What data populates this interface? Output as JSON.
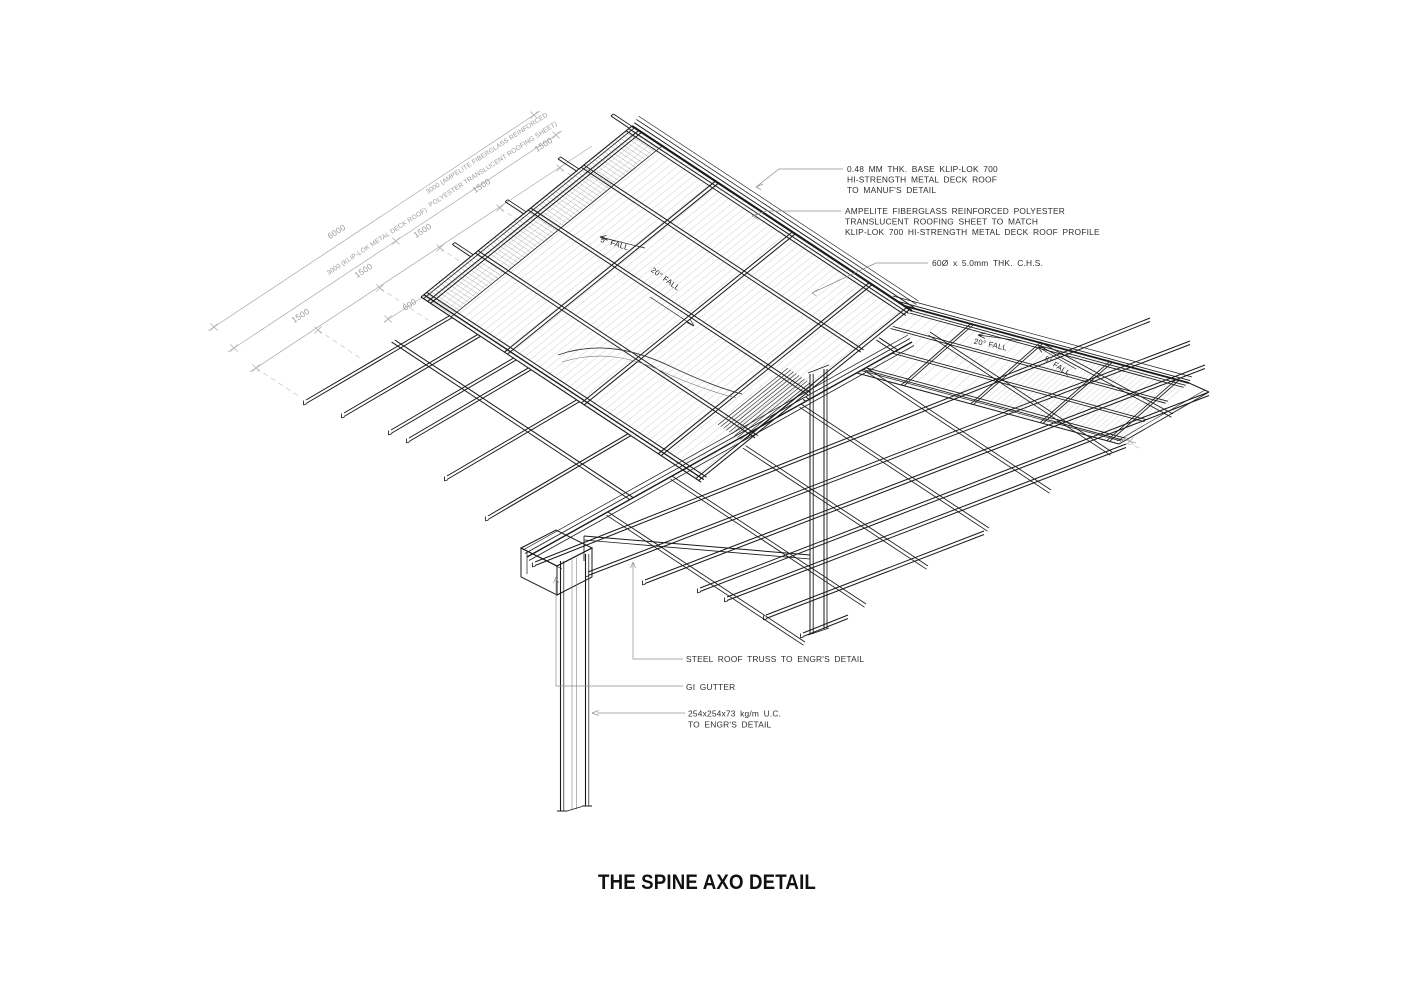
{
  "title": "THE SPINE AXO DETAIL",
  "colors": {
    "line": "#1a1a1a",
    "dim_gray": "#9a9a9a",
    "corrugation": "#c4c4c4",
    "note_text": "#2e2e2e",
    "background": "#ffffff"
  },
  "dimensions": {
    "bays": [
      "1500",
      "1500",
      "1500",
      "1500",
      "1500"
    ],
    "offset_600": "600",
    "total_span": "6000",
    "span_kliplok": "3000 (KLIP-LOK METAL DECK ROOF)",
    "span_ampelite_1": "3000 (AMPELITE FIBERGLASS REINFORCED",
    "span_ampelite_2": "POLYESTER TRANSLUCENT ROOFING SHEET)",
    "edge_650": "650"
  },
  "falls": {
    "left_low": "5° FALL",
    "left_steep": "20° FALL",
    "right_steep": "20° FALL",
    "right_low": "5° FALL"
  },
  "notes": {
    "metal_deck": [
      "0.48 MM THK. BASE KLIP-LOK 700",
      "HI-STRENGTH METAL DECK ROOF",
      "TO MANUF'S DETAIL"
    ],
    "translucent": [
      "AMPELITE FIBERGLASS REINFORCED POLYESTER",
      "TRANSLUCENT ROOFING SHEET TO MATCH",
      "KLIP-LOK 700 HI-STRENGTH METAL DECK ROOF PROFILE"
    ],
    "chs": "60Ø x 5.0mm THK. C.H.S.",
    "truss": "STEEL ROOF TRUSS TO ENGR'S DETAIL",
    "gutter": "GI GUTTER",
    "column": [
      "254x254x73 kg/m U.C.",
      "TO ENGR'S DETAIL"
    ]
  }
}
